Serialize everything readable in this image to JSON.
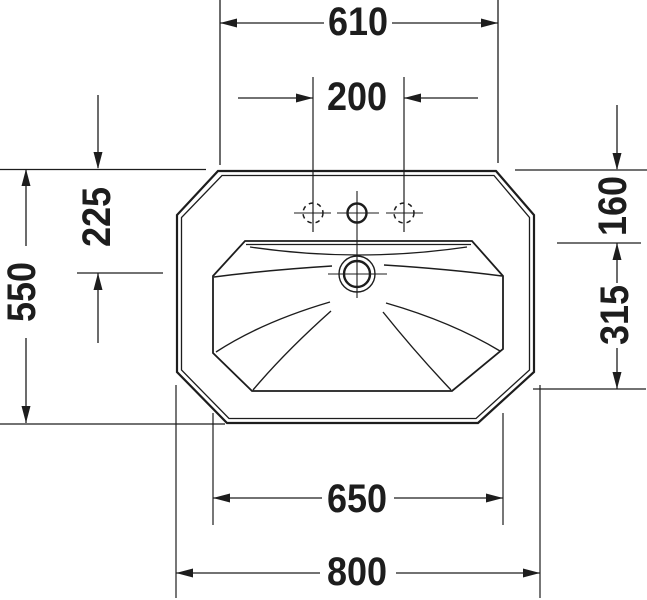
{
  "drawing": {
    "colors": {
      "line": "#1d1d1d",
      "background": "#ffffff"
    },
    "dimensions": [
      {
        "id": "top-width",
        "value": "610",
        "orientation": "horizontal"
      },
      {
        "id": "tap-hole-spacing",
        "value": "200",
        "orientation": "horizontal"
      },
      {
        "id": "rim-to-overflow",
        "value": "225",
        "orientation": "vertical"
      },
      {
        "id": "overall-depth",
        "value": "550",
        "orientation": "vertical"
      },
      {
        "id": "rim-to-bowl-front",
        "value": "160",
        "orientation": "vertical"
      },
      {
        "id": "bowl-depth",
        "value": "315",
        "orientation": "vertical"
      },
      {
        "id": "bowl-width",
        "value": "650",
        "orientation": "horizontal"
      },
      {
        "id": "overall-width",
        "value": "800",
        "orientation": "horizontal"
      }
    ]
  }
}
